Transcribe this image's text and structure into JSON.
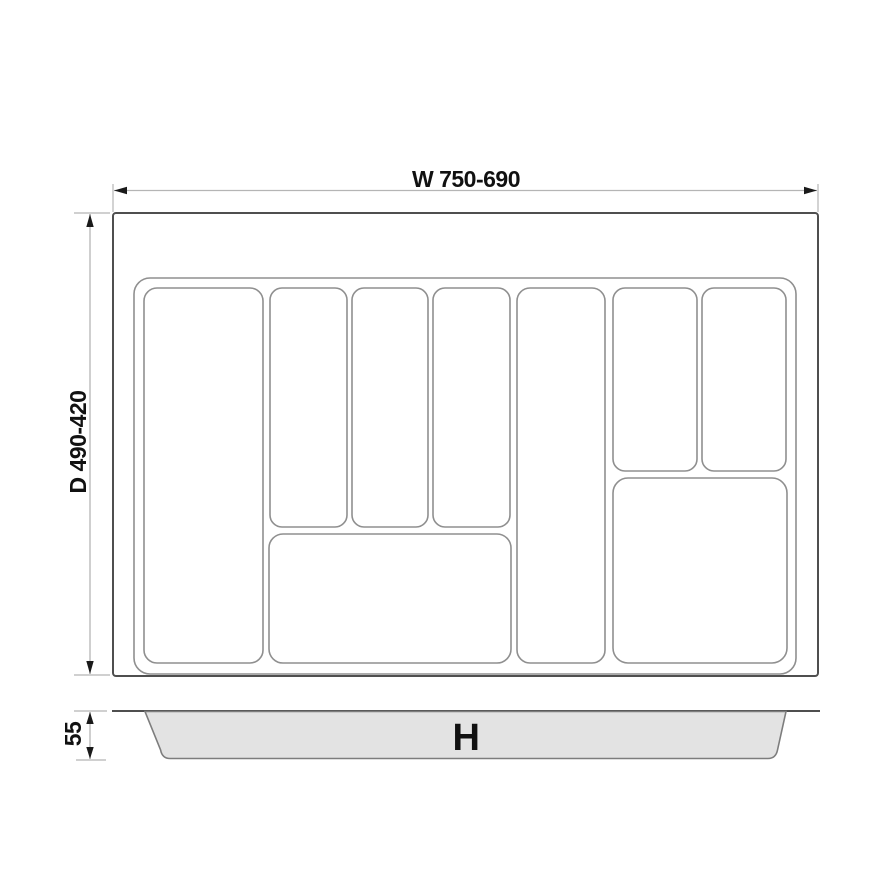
{
  "drawing": {
    "dimensions": {
      "width": "W 750-690",
      "depth": "D 490-420",
      "tray_height": "55",
      "drawer_height": "H"
    },
    "views": {
      "top_view": {
        "compartment_count": 9
      },
      "side_view": {
        "label": "H"
      }
    },
    "colors": {
      "background": "#ffffff",
      "outline_dark": "#4f4f4f",
      "outline_light": "#8f8f8f",
      "dimension_line": "#b5b5b5",
      "arrow": "#1a1a1a",
      "text": "#111111",
      "side_profile_fill": "#e3e3e3"
    }
  }
}
